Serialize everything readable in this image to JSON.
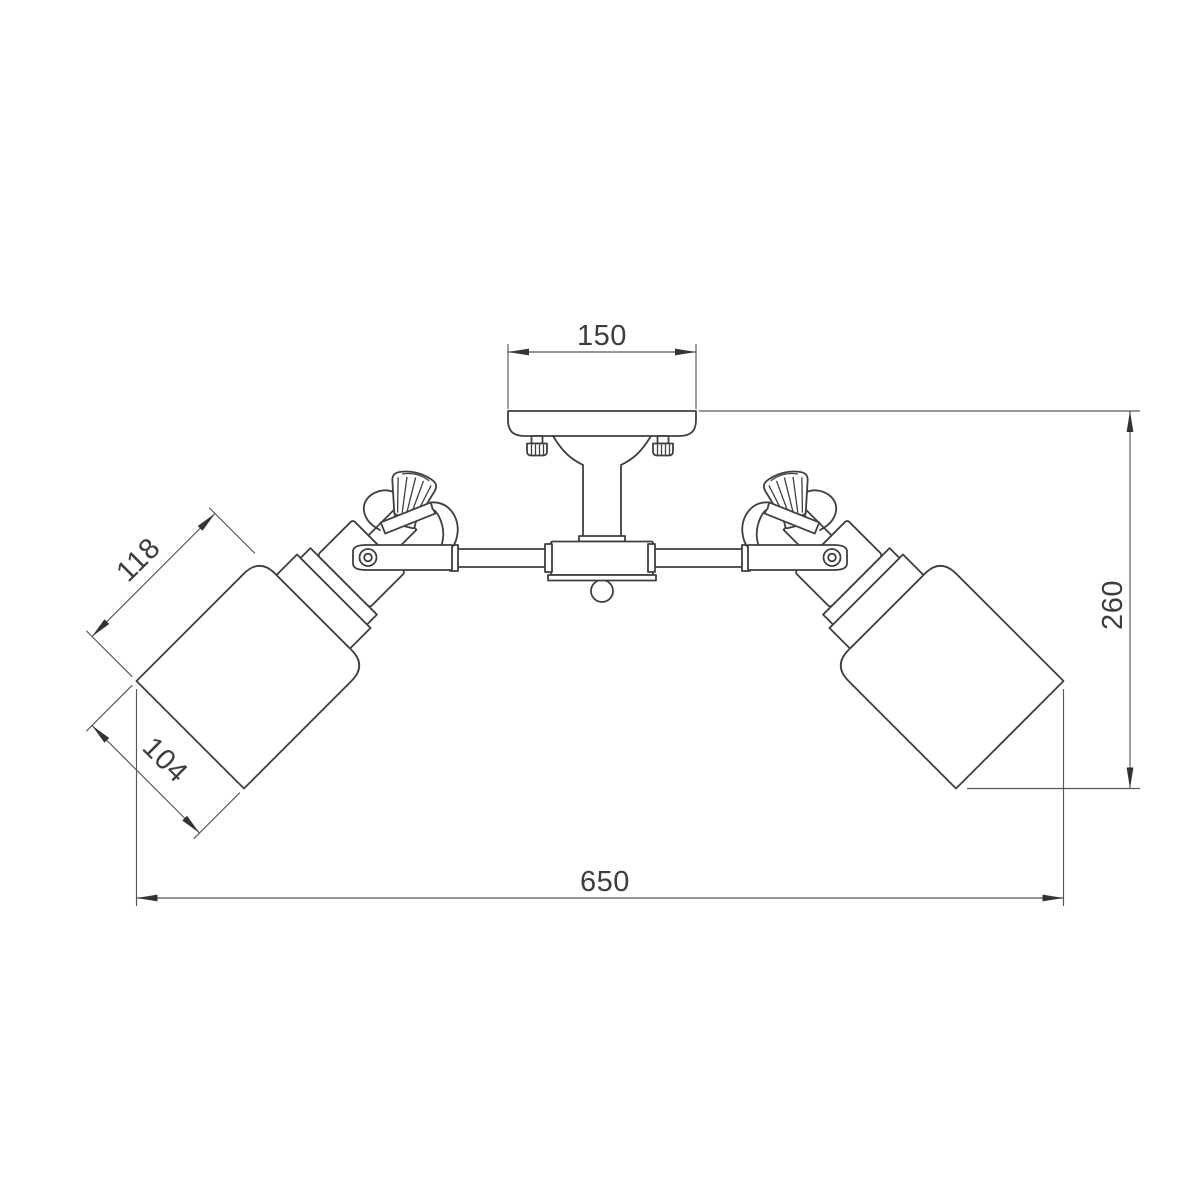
{
  "drawing": {
    "description": "Technical dimension drawing of a two-arm ceiling light fixture with cylindrical shades",
    "dimensions": {
      "canopy_width_mm": "150",
      "fixture_height_mm": "260",
      "shade_height_mm": "118",
      "shade_diameter_mm": "104",
      "fixture_width_mm": "650"
    },
    "colors": {
      "object_line": "#3f3f3f",
      "dimension_line": "#585858",
      "arrow_fill": "#333333",
      "text": "#3d3d3d",
      "background": "#ffffff"
    }
  }
}
